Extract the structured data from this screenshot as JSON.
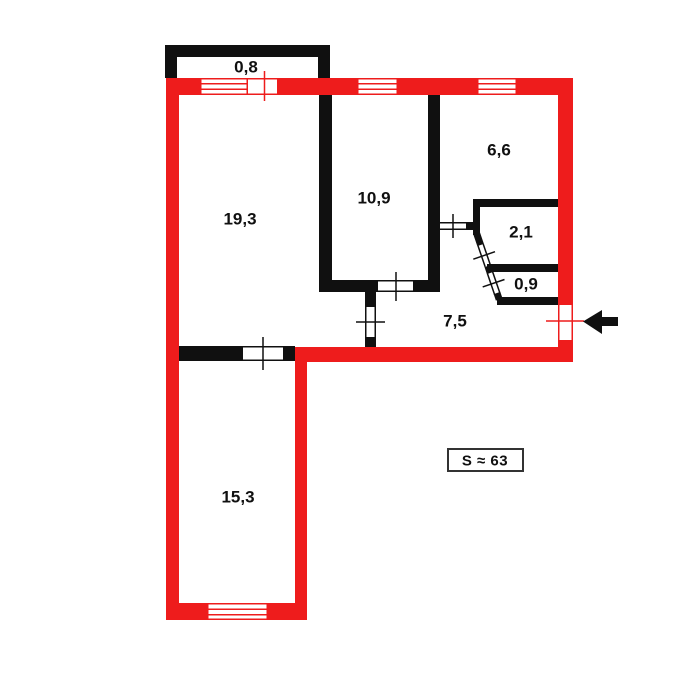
{
  "title": "apartment-floor-plan",
  "colors": {
    "wall_exterior": "#ee1c1c",
    "wall_interior": "#101010",
    "text": "#101010",
    "total_box_border": "#333333",
    "background": "#ffffff"
  },
  "rooms": {
    "balcony": {
      "area": "0,8"
    },
    "living_room": {
      "area": "19,3"
    },
    "bedroom": {
      "area": "10,9"
    },
    "kitchen": {
      "area": "6,6"
    },
    "bathroom": {
      "area": "2,1"
    },
    "toilet": {
      "area": "0,9"
    },
    "hallway": {
      "area": "7,5"
    },
    "second_room": {
      "area": "15,3"
    }
  },
  "total_area": {
    "label": "S ≈ 63"
  },
  "entrance": {
    "icon": "left-arrow"
  }
}
